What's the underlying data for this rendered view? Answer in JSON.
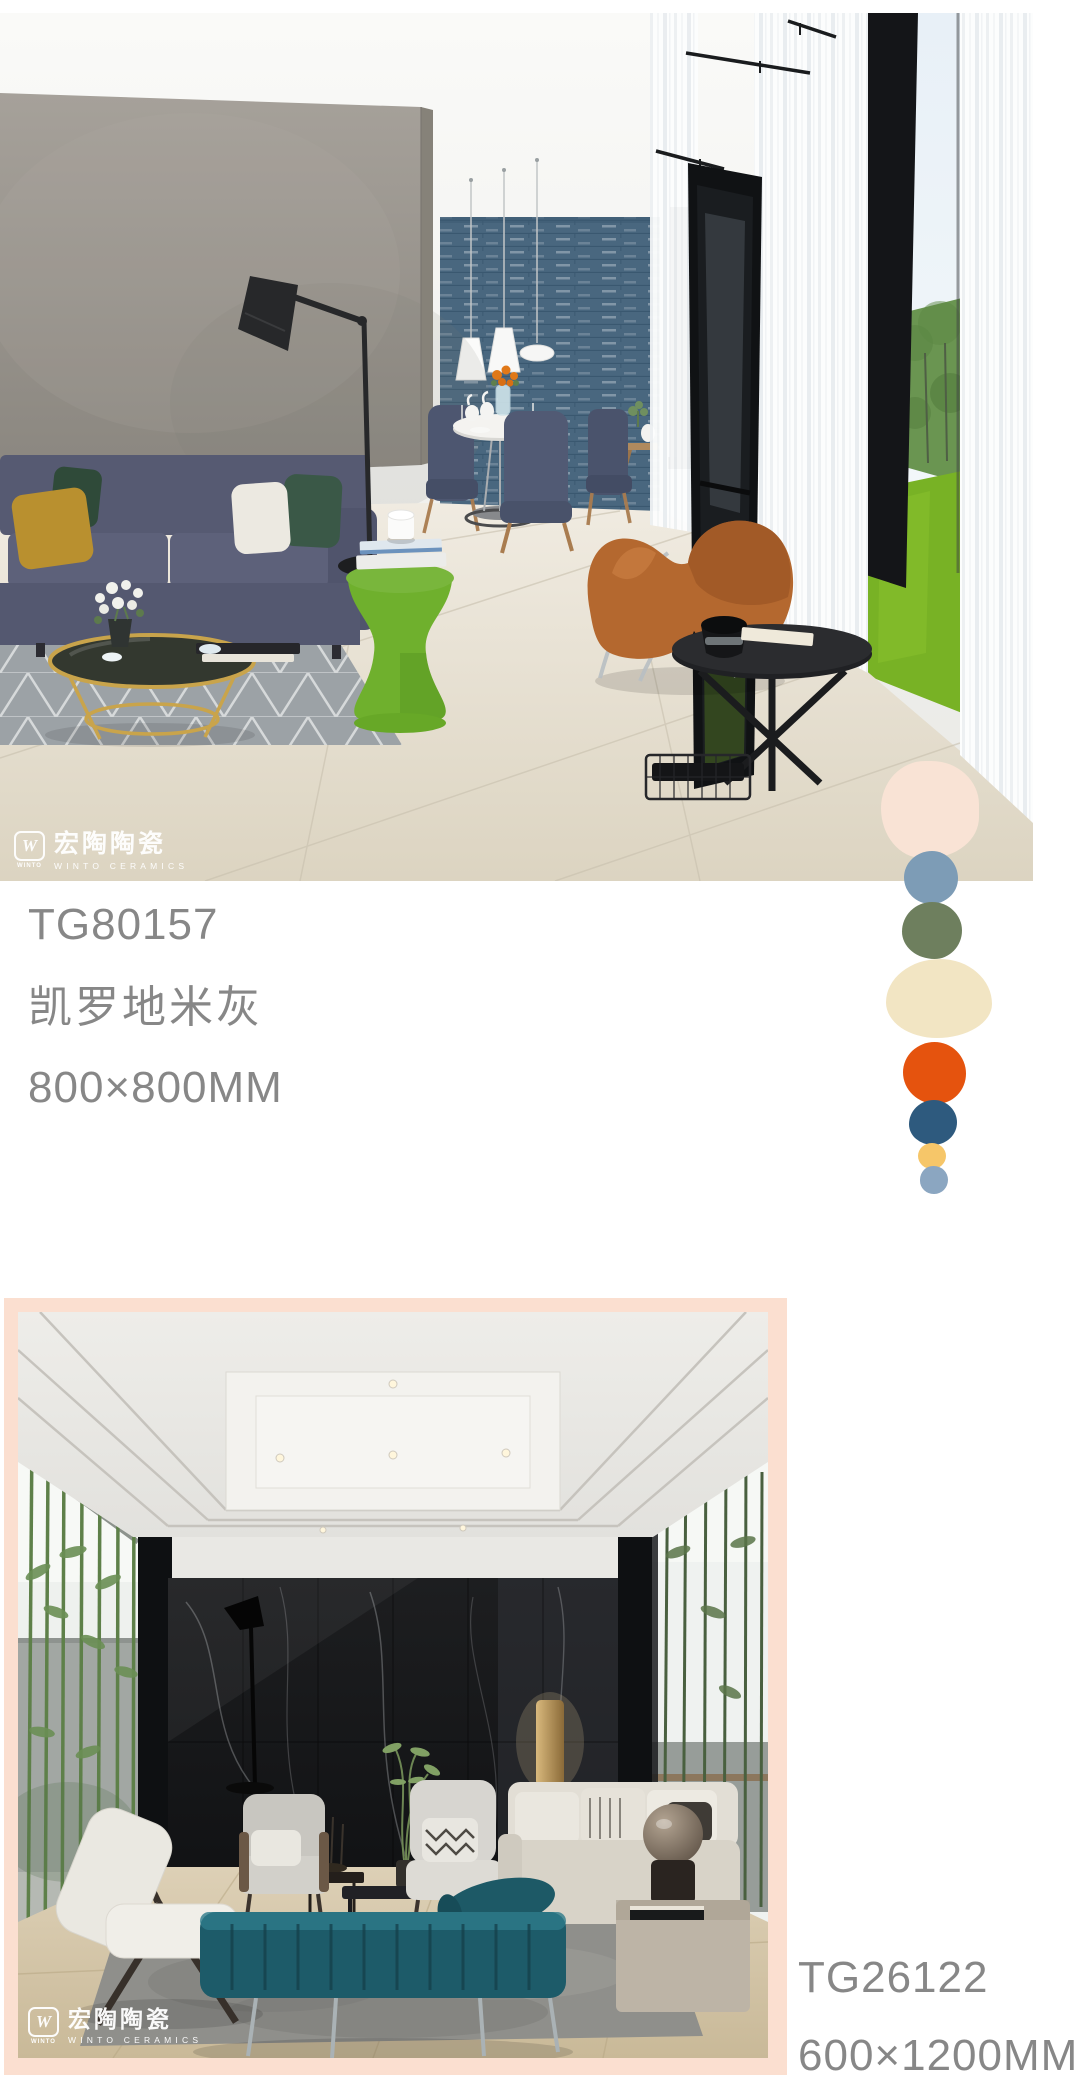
{
  "brand": {
    "name_zh": "宏陶陶瓷",
    "name_en": "WINTO CERAMICS",
    "mark_letter": "W",
    "mark_caption": "WINTO"
  },
  "products": [
    {
      "code": "TG80157",
      "name": "凯罗地米灰",
      "size": "800×800MM"
    },
    {
      "code": "TG26122",
      "size": "600×1200MM"
    }
  ],
  "palette_dots": [
    {
      "name": "blush",
      "color": "#f9e3d5"
    },
    {
      "name": "steel-blue",
      "color": "#7d9cb6"
    },
    {
      "name": "olive-green",
      "color": "#6e7f5e"
    },
    {
      "name": "cream",
      "color": "#f2e5c3"
    },
    {
      "name": "orange",
      "color": "#e5530e"
    },
    {
      "name": "navy",
      "color": "#2e5a7e"
    },
    {
      "name": "yellow",
      "color": "#f6c669"
    },
    {
      "name": "light-blue",
      "color": "#8ba6c1"
    }
  ],
  "colors": {
    "caption_text": "#878787",
    "frame_pink": "#fbdfd0",
    "page_bg": "#ffffff"
  }
}
